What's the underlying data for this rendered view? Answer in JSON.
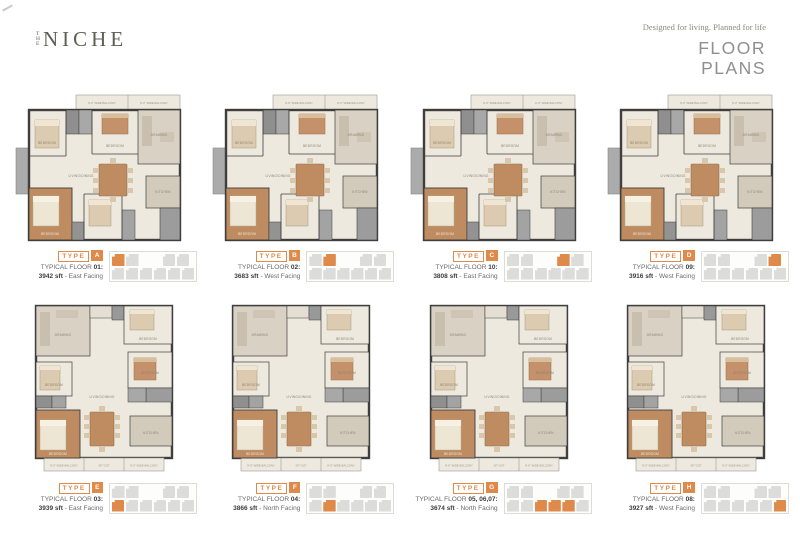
{
  "page": {
    "brand_the": "THE",
    "brand_name": "NICHE",
    "tagline": "Designed for living. Planned for life",
    "title_line1": "FLOOR",
    "title_line2": "PLANS"
  },
  "captions": {
    "type_word": "TYPE",
    "floor_label": "TYPICAL FLOOR",
    "separator": "-"
  },
  "room_labels": {
    "bedroom": "BEDROOM",
    "living_dining": "LIVING/DINING",
    "kitchen": "KITCHEN",
    "drawing": "DRAWING",
    "balcony": "9'-0\" WIDE BALCONY",
    "sitout": "SIT OUT",
    "toilet": "TOILET",
    "dress": "DRESS"
  },
  "colors": {
    "accent_orange": "#DE8A4B",
    "wall_dark": "#3F3E3C",
    "floor_cream": "#EDE9DF",
    "floor_beige": "#D9D2C4",
    "room_tan": "#BE8C60",
    "furn_tan_light": "#DCCBB0",
    "balcony_gray": "#ABABAB",
    "toilet_gray": "#8F8F8F",
    "key_unit_gray": "#DCDCDA",
    "logo_gray": "#5E5E54",
    "title_gray": "#8F8F8F",
    "text_dark": "#3C3C3C"
  },
  "plans": [
    {
      "type_letter": "A",
      "floor_value": "01:",
      "area": "3942 sft",
      "facing": "East Facing",
      "orientation": "landscape",
      "key_row": "top",
      "key_units": [
        0
      ]
    },
    {
      "type_letter": "B",
      "floor_value": "02:",
      "area": "3683 sft",
      "facing": "West Facing",
      "orientation": "landscape",
      "key_row": "top",
      "key_units": [
        1
      ]
    },
    {
      "type_letter": "C",
      "floor_value": "10:",
      "area": "3808 sft",
      "facing": "East Facing",
      "orientation": "landscape",
      "key_row": "top",
      "key_units": [
        2
      ]
    },
    {
      "type_letter": "D",
      "floor_value": "09:",
      "area": "3916 sft",
      "facing": "West Facing",
      "orientation": "landscape",
      "key_row": "top",
      "key_units": [
        3
      ]
    },
    {
      "type_letter": "E",
      "floor_value": "03:",
      "area": "3939 sft",
      "facing": "East Facing",
      "orientation": "portrait",
      "key_row": "bottom",
      "key_units": [
        0
      ]
    },
    {
      "type_letter": "F",
      "floor_value": "04:",
      "area": "3866 sft",
      "facing": "North Facing",
      "orientation": "portrait",
      "key_row": "bottom",
      "key_units": [
        1
      ]
    },
    {
      "type_letter": "G",
      "floor_value": "05, 06,07:",
      "area": "3674 sft",
      "facing": "North Facing",
      "orientation": "portrait",
      "key_row": "bottom",
      "key_units": [
        2,
        3,
        4
      ]
    },
    {
      "type_letter": "H",
      "floor_value": "08:",
      "area": "3927 sft",
      "facing": "West Facing",
      "orientation": "portrait",
      "key_row": "bottom",
      "key_units": [
        5
      ]
    }
  ]
}
